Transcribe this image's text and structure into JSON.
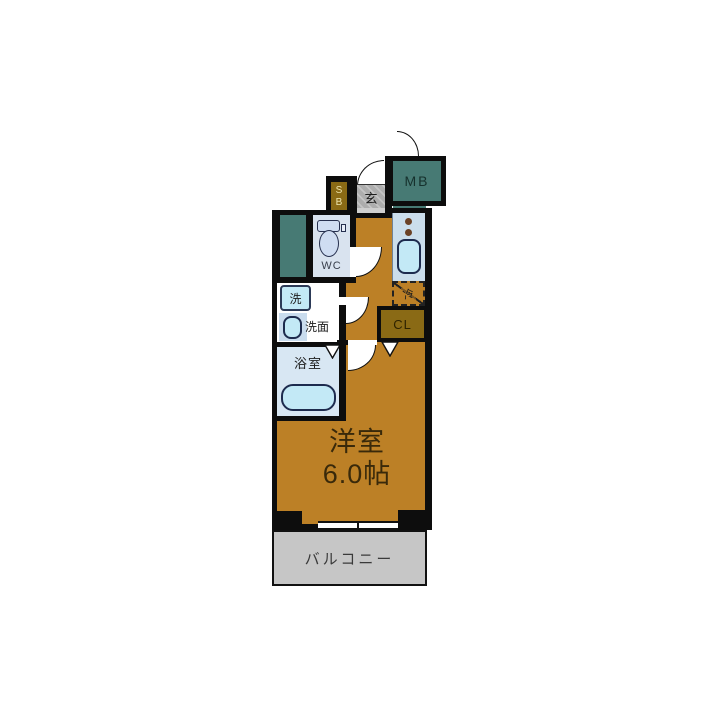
{
  "floorplan": {
    "rooms": {
      "main_room": {
        "name": "洋室",
        "size": "6.0帖"
      },
      "balcony": {
        "label": "バルコニー"
      },
      "bathroom": {
        "label": "浴室"
      },
      "vanity": {
        "label": "洗面"
      },
      "washer": {
        "label": "洗"
      },
      "wc": {
        "label": "WC"
      },
      "entrance": {
        "label": "玄"
      },
      "shoe_box": {
        "line1": "S",
        "line2": "B"
      },
      "meter_box": {
        "label": "MB"
      },
      "closet": {
        "label": "CL"
      },
      "refrigerator": {
        "label": "冷"
      }
    },
    "colors": {
      "floor": "#bc8026",
      "teal": "#477a74",
      "closet_fill": "#8a6a15",
      "balcony_fill": "#c6c6c6",
      "wet_room_fill": "#d8e6f2",
      "fixture_fill": "#c3e9f6",
      "wall": "#0d0d0d"
    }
  }
}
